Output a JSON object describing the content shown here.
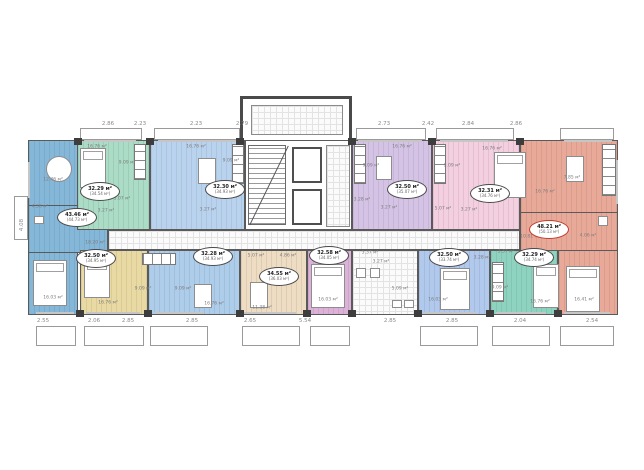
{
  "plan": {
    "colors": {
      "wall": "#4a4a4a",
      "accent_badge": "#c43b2e",
      "blue": "#85b7d9",
      "mint": "#aadcc6",
      "lblue": "#b9d3ee",
      "purple": "#d5c3e6",
      "pink": "#f3cfe0",
      "salmon": "#e9a999",
      "yellow": "#e9d9a2",
      "lblue2": "#aecdea",
      "cream": "#eedcc3",
      "magenta": "#ddb2d8",
      "periwinkle": "#b0c9ec",
      "teal": "#8ed3bf",
      "corridor": "#fbfbfb"
    },
    "apartments": [
      {
        "name": "corner-left-blue",
        "area": "43.46 м²",
        "total": "(44.73 м²)"
      },
      {
        "name": "mint",
        "area": "32.29 м²",
        "total": "(34.54 м²)"
      },
      {
        "name": "light-blue",
        "area": "32.30 м²",
        "total": "(34.93 м²)"
      },
      {
        "name": "purple",
        "area": "32.50 м²",
        "total": "(35.07 м²)"
      },
      {
        "name": "pink",
        "area": "32.31 м²",
        "total": "(34.76 м²)"
      },
      {
        "name": "corner-right-salmon",
        "area": "48.21 м²",
        "total": "(50.13 м²)"
      },
      {
        "name": "yellow",
        "area": "32.50 м²",
        "total": "(34.95 м²)"
      },
      {
        "name": "light-blue-2",
        "area": "32.28 м²",
        "total": "(34.93 м²)"
      },
      {
        "name": "cream",
        "area": "34.55 м²",
        "total": "(36.03 м²)"
      },
      {
        "name": "magenta",
        "area": "32.58 м²",
        "total": "(34.05 м²)"
      },
      {
        "name": "periwinkle",
        "area": "32.50 м²",
        "total": "(33.74 м²)"
      },
      {
        "name": "teal",
        "area": "32.29 м²",
        "total": "(34.74 м²)"
      }
    ],
    "room_labels": [
      {
        "t": "12.46 м²",
        "x": 53,
        "y": 180
      },
      {
        "t": "4.36 м²",
        "x": 40,
        "y": 207
      },
      {
        "t": "18.20 м²",
        "x": 95,
        "y": 243
      },
      {
        "t": "16.03 м²",
        "x": 53,
        "y": 298
      },
      {
        "t": "16.76 м²",
        "x": 97,
        "y": 147
      },
      {
        "t": "9.09 м²",
        "x": 127,
        "y": 163
      },
      {
        "t": "5.07 м²",
        "x": 122,
        "y": 199
      },
      {
        "t": "3.27 м²",
        "x": 106,
        "y": 211
      },
      {
        "t": "16.76 м²",
        "x": 196,
        "y": 147
      },
      {
        "t": "9.09 м²",
        "x": 231,
        "y": 161
      },
      {
        "t": "3.28 м²",
        "x": 233,
        "y": 197
      },
      {
        "t": "3.27 м²",
        "x": 208,
        "y": 210
      },
      {
        "t": "16.76 м²",
        "x": 402,
        "y": 147
      },
      {
        "t": "9.09 м²",
        "x": 371,
        "y": 166
      },
      {
        "t": "3.28 м²",
        "x": 362,
        "y": 200
      },
      {
        "t": "3.27 м²",
        "x": 389,
        "y": 208
      },
      {
        "t": "16.76 м²",
        "x": 492,
        "y": 149
      },
      {
        "t": "9.09 м²",
        "x": 452,
        "y": 166
      },
      {
        "t": "5.07 м²",
        "x": 443,
        "y": 209
      },
      {
        "t": "3.27 м²",
        "x": 469,
        "y": 210
      },
      {
        "t": "7.85 м²",
        "x": 572,
        "y": 178
      },
      {
        "t": "16.76 м²",
        "x": 545,
        "y": 192
      },
      {
        "t": "10.81 м²",
        "x": 530,
        "y": 237
      },
      {
        "t": "4.06 м²",
        "x": 588,
        "y": 236
      },
      {
        "t": "16.41 м²",
        "x": 584,
        "y": 300
      },
      {
        "t": "16.76 м²",
        "x": 108,
        "y": 303
      },
      {
        "t": "9.09 м²",
        "x": 143,
        "y": 289
      },
      {
        "t": "9.09 м²",
        "x": 183,
        "y": 289
      },
      {
        "t": "16.76 м²",
        "x": 214,
        "y": 304
      },
      {
        "t": "5.07 м²",
        "x": 256,
        "y": 256
      },
      {
        "t": "4.86 м²",
        "x": 288,
        "y": 256
      },
      {
        "t": "11.38 м²",
        "x": 262,
        "y": 308
      },
      {
        "t": "16.03 м²",
        "x": 328,
        "y": 300
      },
      {
        "t": "3.37 м²",
        "x": 370,
        "y": 253
      },
      {
        "t": "3.27 м²",
        "x": 381,
        "y": 262
      },
      {
        "t": "5.09 м²",
        "x": 400,
        "y": 289
      },
      {
        "t": "3.28 м²",
        "x": 482,
        "y": 258
      },
      {
        "t": "3.37 м²",
        "x": 506,
        "y": 252
      },
      {
        "t": "9.09 м²",
        "x": 500,
        "y": 288
      },
      {
        "t": "16.76 м²",
        "x": 540,
        "y": 302
      },
      {
        "t": "16.03 м²",
        "x": 438,
        "y": 300
      }
    ],
    "dims_top": [
      {
        "t": "2.86",
        "x": 108,
        "y": 124
      },
      {
        "t": "2.23",
        "x": 140,
        "y": 124
      },
      {
        "t": "2.23",
        "x": 196,
        "y": 124
      },
      {
        "t": "2.79",
        "x": 242,
        "y": 124
      },
      {
        "t": "2.73",
        "x": 384,
        "y": 124
      },
      {
        "t": "2.42",
        "x": 428,
        "y": 124
      },
      {
        "t": "2.84",
        "x": 468,
        "y": 124
      },
      {
        "t": "2.86",
        "x": 516,
        "y": 124
      }
    ],
    "dims_bottom": [
      {
        "t": "2.55",
        "x": 43,
        "y": 321
      },
      {
        "t": "2.06",
        "x": 94,
        "y": 321
      },
      {
        "t": "2.85",
        "x": 128,
        "y": 321
      },
      {
        "t": "2.85",
        "x": 192,
        "y": 321
      },
      {
        "t": "2.65",
        "x": 250,
        "y": 321
      },
      {
        "t": "5.54",
        "x": 305,
        "y": 321
      },
      {
        "t": "2.85",
        "x": 390,
        "y": 321
      },
      {
        "t": "2.85",
        "x": 452,
        "y": 321
      },
      {
        "t": "2.04",
        "x": 520,
        "y": 321
      },
      {
        "t": "2.54",
        "x": 592,
        "y": 321
      }
    ],
    "side_dim": "4.08"
  }
}
